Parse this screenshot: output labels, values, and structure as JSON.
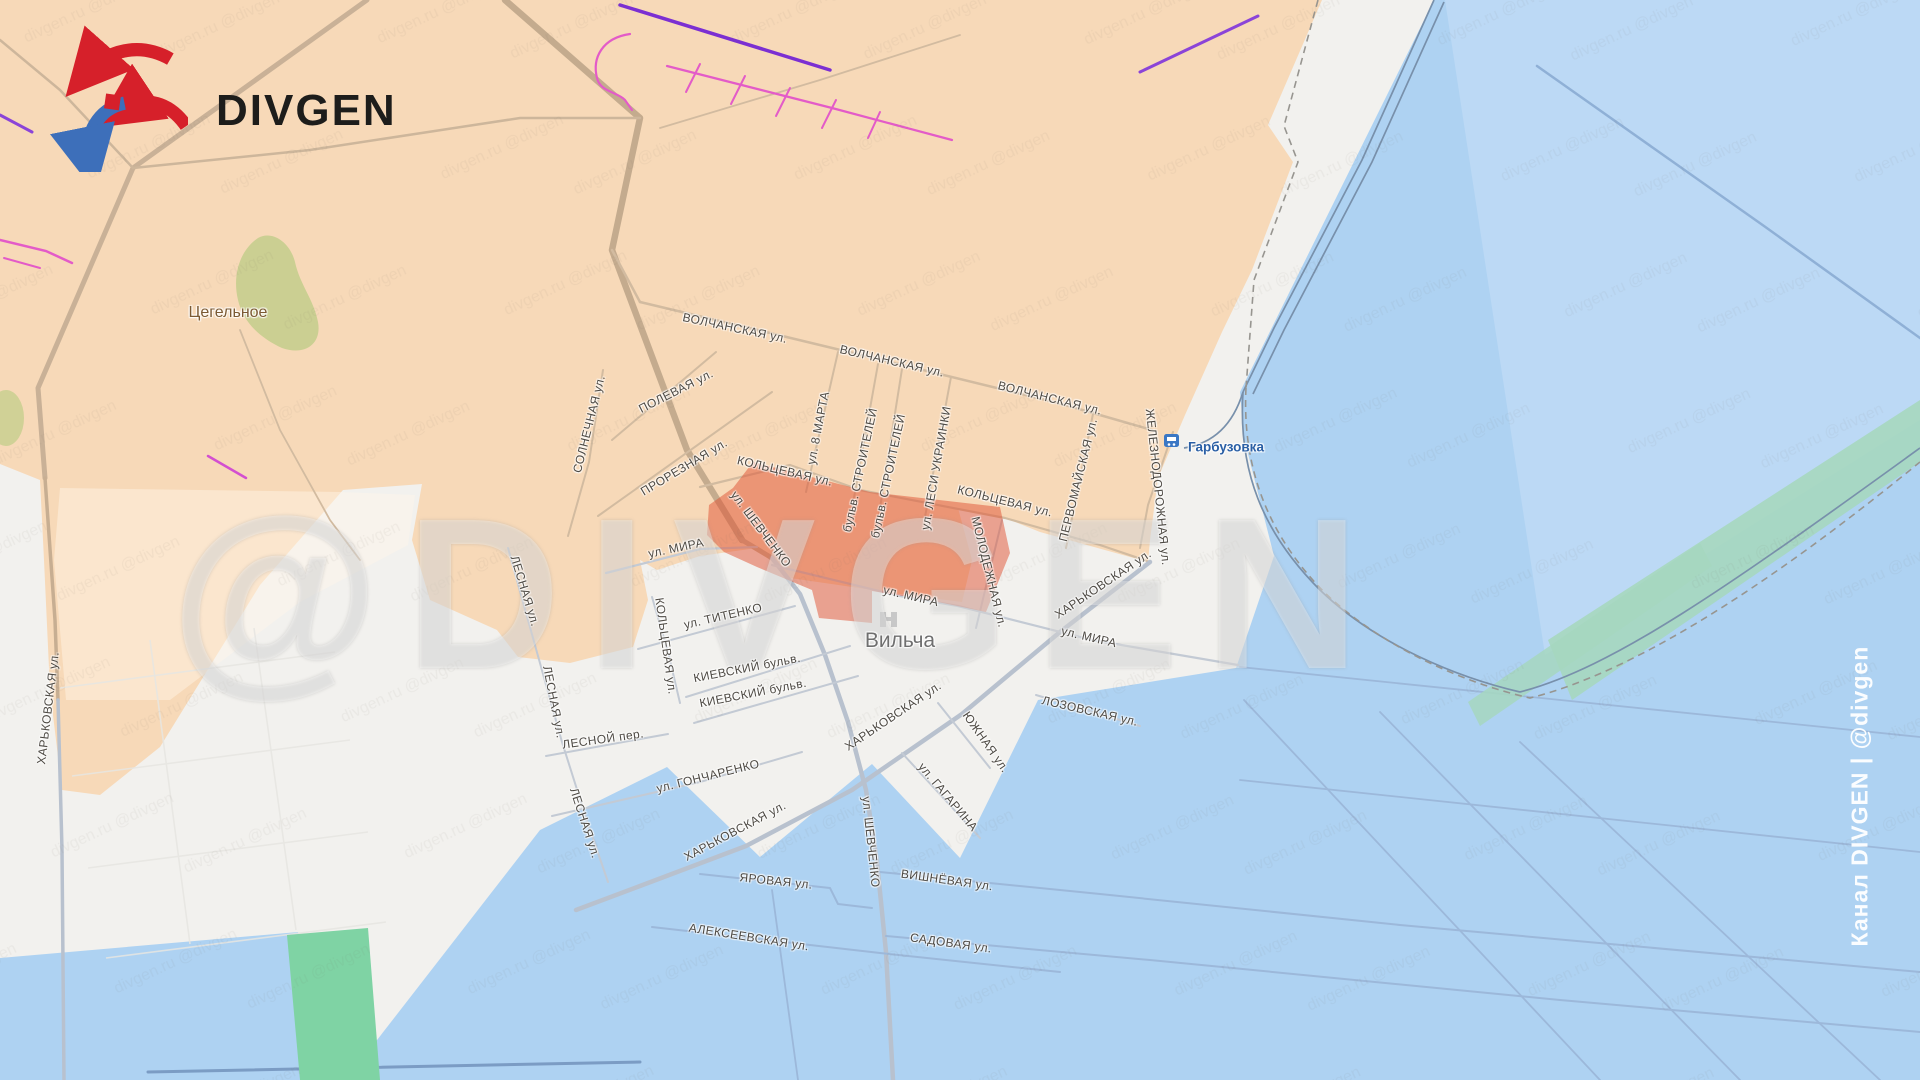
{
  "brand": {
    "name": "DIVGEN"
  },
  "watermarks": {
    "channel": "Канал DIVGEN | @divgen",
    "big": "@DIVGEN",
    "tiled": "divgen.ru  @divgen"
  },
  "legend_colors": {
    "zone_orange": "#f7d9b8",
    "zone_white": "#f2f1ee",
    "zone_blue": "#aed2f2",
    "zone_blue_light": "#bcd9f5",
    "advance_red": "rgba(224,82,50,0.5)",
    "green_park": "#cbcf92",
    "green_band": "#a6d7bf",
    "green_field": "#7fd3a4",
    "fortification_pink": "#e35bc8",
    "fortification_purple": "#7b2fd2",
    "station_blue": "#3b77c4"
  },
  "places": [
    {
      "name": "Цегельное",
      "x": 228,
      "y": 313,
      "fs": 16,
      "color": "#7c5a33",
      "weight": 400
    },
    {
      "name": "Вильча",
      "x": 900,
      "y": 641,
      "fs": 21,
      "color": "#6f6f6f",
      "weight": 400
    },
    {
      "name": "Гарбузовка",
      "x": 1226,
      "y": 447,
      "fs": 13.5,
      "color": "#2a5fa5",
      "weight": 700
    }
  ],
  "streets": [
    {
      "label": "ВОЛЧАНСКАЯ ул.",
      "x": 735,
      "y": 328,
      "r": 12
    },
    {
      "label": "ВОЛЧАНСКАЯ ул.",
      "x": 892,
      "y": 361,
      "r": 13
    },
    {
      "label": "ВОЛЧАНСКАЯ ул.",
      "x": 1050,
      "y": 398,
      "r": 14
    },
    {
      "label": "ПОЛЕВАЯ ул.",
      "x": 676,
      "y": 391,
      "r": -27
    },
    {
      "label": "СОЛНЕЧНАЯ ул.",
      "x": 589,
      "y": 424,
      "r": -76
    },
    {
      "label": "ПРОРЕЗНАЯ ул.",
      "x": 684,
      "y": 467,
      "r": -31
    },
    {
      "label": "ул. 8 МАРТА",
      "x": 818,
      "y": 428,
      "r": -79
    },
    {
      "label": "бульв. СТРОИТЕЛЕЙ",
      "x": 860,
      "y": 470,
      "r": -78
    },
    {
      "label": "бульв. СТРОИТЕЛЕЙ",
      "x": 888,
      "y": 476,
      "r": -78
    },
    {
      "label": "ул. ЛЕСИ УКРАИНКИ",
      "x": 936,
      "y": 468,
      "r": -80
    },
    {
      "label": "КОЛЬЦЕВАЯ ул.",
      "x": 785,
      "y": 471,
      "r": 13
    },
    {
      "label": "КОЛЬЦЕВАЯ ул.",
      "x": 1005,
      "y": 501,
      "r": 14
    },
    {
      "label": "ПЕРВОМАЙСКАЯ ул.",
      "x": 1078,
      "y": 480,
      "r": -76
    },
    {
      "label": "ЖЕЛЕЗНОДОРОЖНАЯ ул.",
      "x": 1158,
      "y": 487,
      "r": 84
    },
    {
      "label": "ул. ШЕВЧЕНКО",
      "x": 761,
      "y": 529,
      "r": 53
    },
    {
      "label": "МОЛОДЕЖНАЯ ул.",
      "x": 989,
      "y": 572,
      "r": 76
    },
    {
      "label": "ул. МИРА",
      "x": 676,
      "y": 548,
      "r": -12
    },
    {
      "label": "ул. МИРА",
      "x": 911,
      "y": 596,
      "r": 13
    },
    {
      "label": "ул. МИРА",
      "x": 1089,
      "y": 637,
      "r": 13
    },
    {
      "label": "ХАРЬКОВСКАЯ ул.",
      "x": 1103,
      "y": 584,
      "r": -34
    },
    {
      "label": "ул. ТИТЕНКО",
      "x": 723,
      "y": 616,
      "r": -13
    },
    {
      "label": "КОЛЬЦЕВАЯ ул.",
      "x": 666,
      "y": 646,
      "r": 82
    },
    {
      "label": "ЛЕСНАЯ ул.",
      "x": 525,
      "y": 591,
      "r": 73
    },
    {
      "label": "КИЕВСКИЙ бульв.",
      "x": 747,
      "y": 668,
      "r": -11
    },
    {
      "label": "КИЕВСКИЙ бульв.",
      "x": 753,
      "y": 693,
      "r": -11
    },
    {
      "label": "ЛЕСНОЙ пер.",
      "x": 603,
      "y": 739,
      "r": -8
    },
    {
      "label": "ЛЕСНАЯ ул.",
      "x": 554,
      "y": 702,
      "r": 79
    },
    {
      "label": "ул. ГОНЧАРЕНКО",
      "x": 708,
      "y": 776,
      "r": -14
    },
    {
      "label": "ХАРЬКОВСКАЯ ул.",
      "x": 893,
      "y": 716,
      "r": -34
    },
    {
      "label": "ХАРЬКОВСКАЯ ул.",
      "x": 735,
      "y": 831,
      "r": -28
    },
    {
      "label": "ЛЕСНАЯ ул.",
      "x": 585,
      "y": 823,
      "r": 72
    },
    {
      "label": "ул. ШЕВЧЕНКО",
      "x": 871,
      "y": 842,
      "r": 84
    },
    {
      "label": "ХАРЬКОВСКАЯ ул.",
      "x": 48,
      "y": 708,
      "r": -83
    },
    {
      "label": "ЛОЗОВСКАЯ ул.",
      "x": 1090,
      "y": 711,
      "r": 13
    },
    {
      "label": "ЮЖНАЯ ул.",
      "x": 986,
      "y": 742,
      "r": 55
    },
    {
      "label": "ул. ГАГАРИНА",
      "x": 948,
      "y": 797,
      "r": 50
    },
    {
      "label": "ВИШНЁВАЯ ул.",
      "x": 947,
      "y": 880,
      "r": 8
    },
    {
      "label": "ЯРОВАЯ ул.",
      "x": 776,
      "y": 881,
      "r": 6
    },
    {
      "label": "САДОВАЯ ул.",
      "x": 951,
      "y": 943,
      "r": 8
    },
    {
      "label": "АЛЕКСЕЕВСКАЯ ул.",
      "x": 749,
      "y": 937,
      "r": 9
    }
  ]
}
